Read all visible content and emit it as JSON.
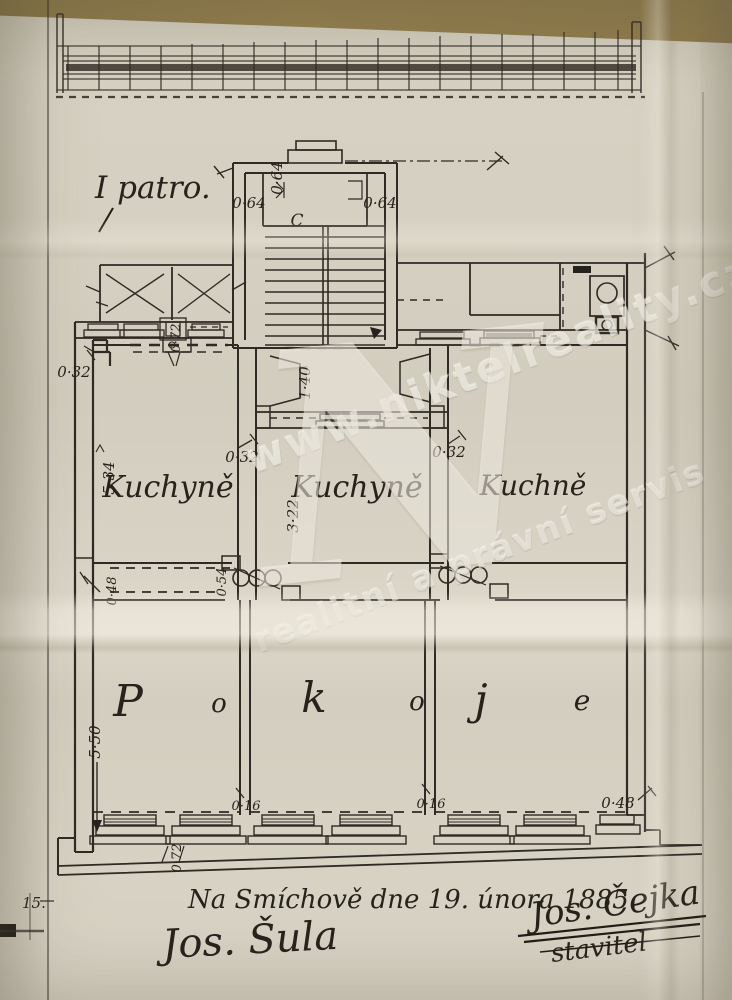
{
  "document": {
    "floor_label": "I patro.",
    "stair_label": "C",
    "date_line": "Na Smíchově dne 19. února 1885.",
    "signature_owner": "Jos. Šula",
    "signature_builder": "Jos. Čejka",
    "builder_title": "stavitel",
    "margin_note": "15."
  },
  "rooms": {
    "kitchen_left": "Kuchyně",
    "kitchen_middle": "Kuchyně",
    "kitchen_right": "Kuchně",
    "bedroom_letters": [
      "P",
      "o",
      "k",
      "o",
      "j",
      "e"
    ]
  },
  "dimensions": {
    "stair_top_width": "0·64",
    "stair_side_left": "0·64",
    "stair_side_right": "0·64",
    "left_wing_wall": "0·72",
    "entry_width": "1·40",
    "wall_left_top": "0·32",
    "kitchen_left_depth": "5·34",
    "kitchen_left_wall": "0·32",
    "kitchen_mid_depth": "3·22",
    "kitchen_mid_wall": "0·32",
    "mid_door": "0·54",
    "room_wall_left": "0·48",
    "room_depth": "5·50",
    "room_wall_a": "0·16",
    "room_wall_b": "0·16",
    "room_wall_right": "0·48",
    "window_pier": "0·72"
  },
  "watermark": {
    "url": "www.niktelreality.cz",
    "tagline": "realitní a právní servis",
    "monogram": "N"
  },
  "colors": {
    "paper": "#d6d1c2",
    "ink": "#2c2822",
    "table_top": "#8e7b4f",
    "watermark_white": "rgba(255,253,246,0.5)"
  }
}
